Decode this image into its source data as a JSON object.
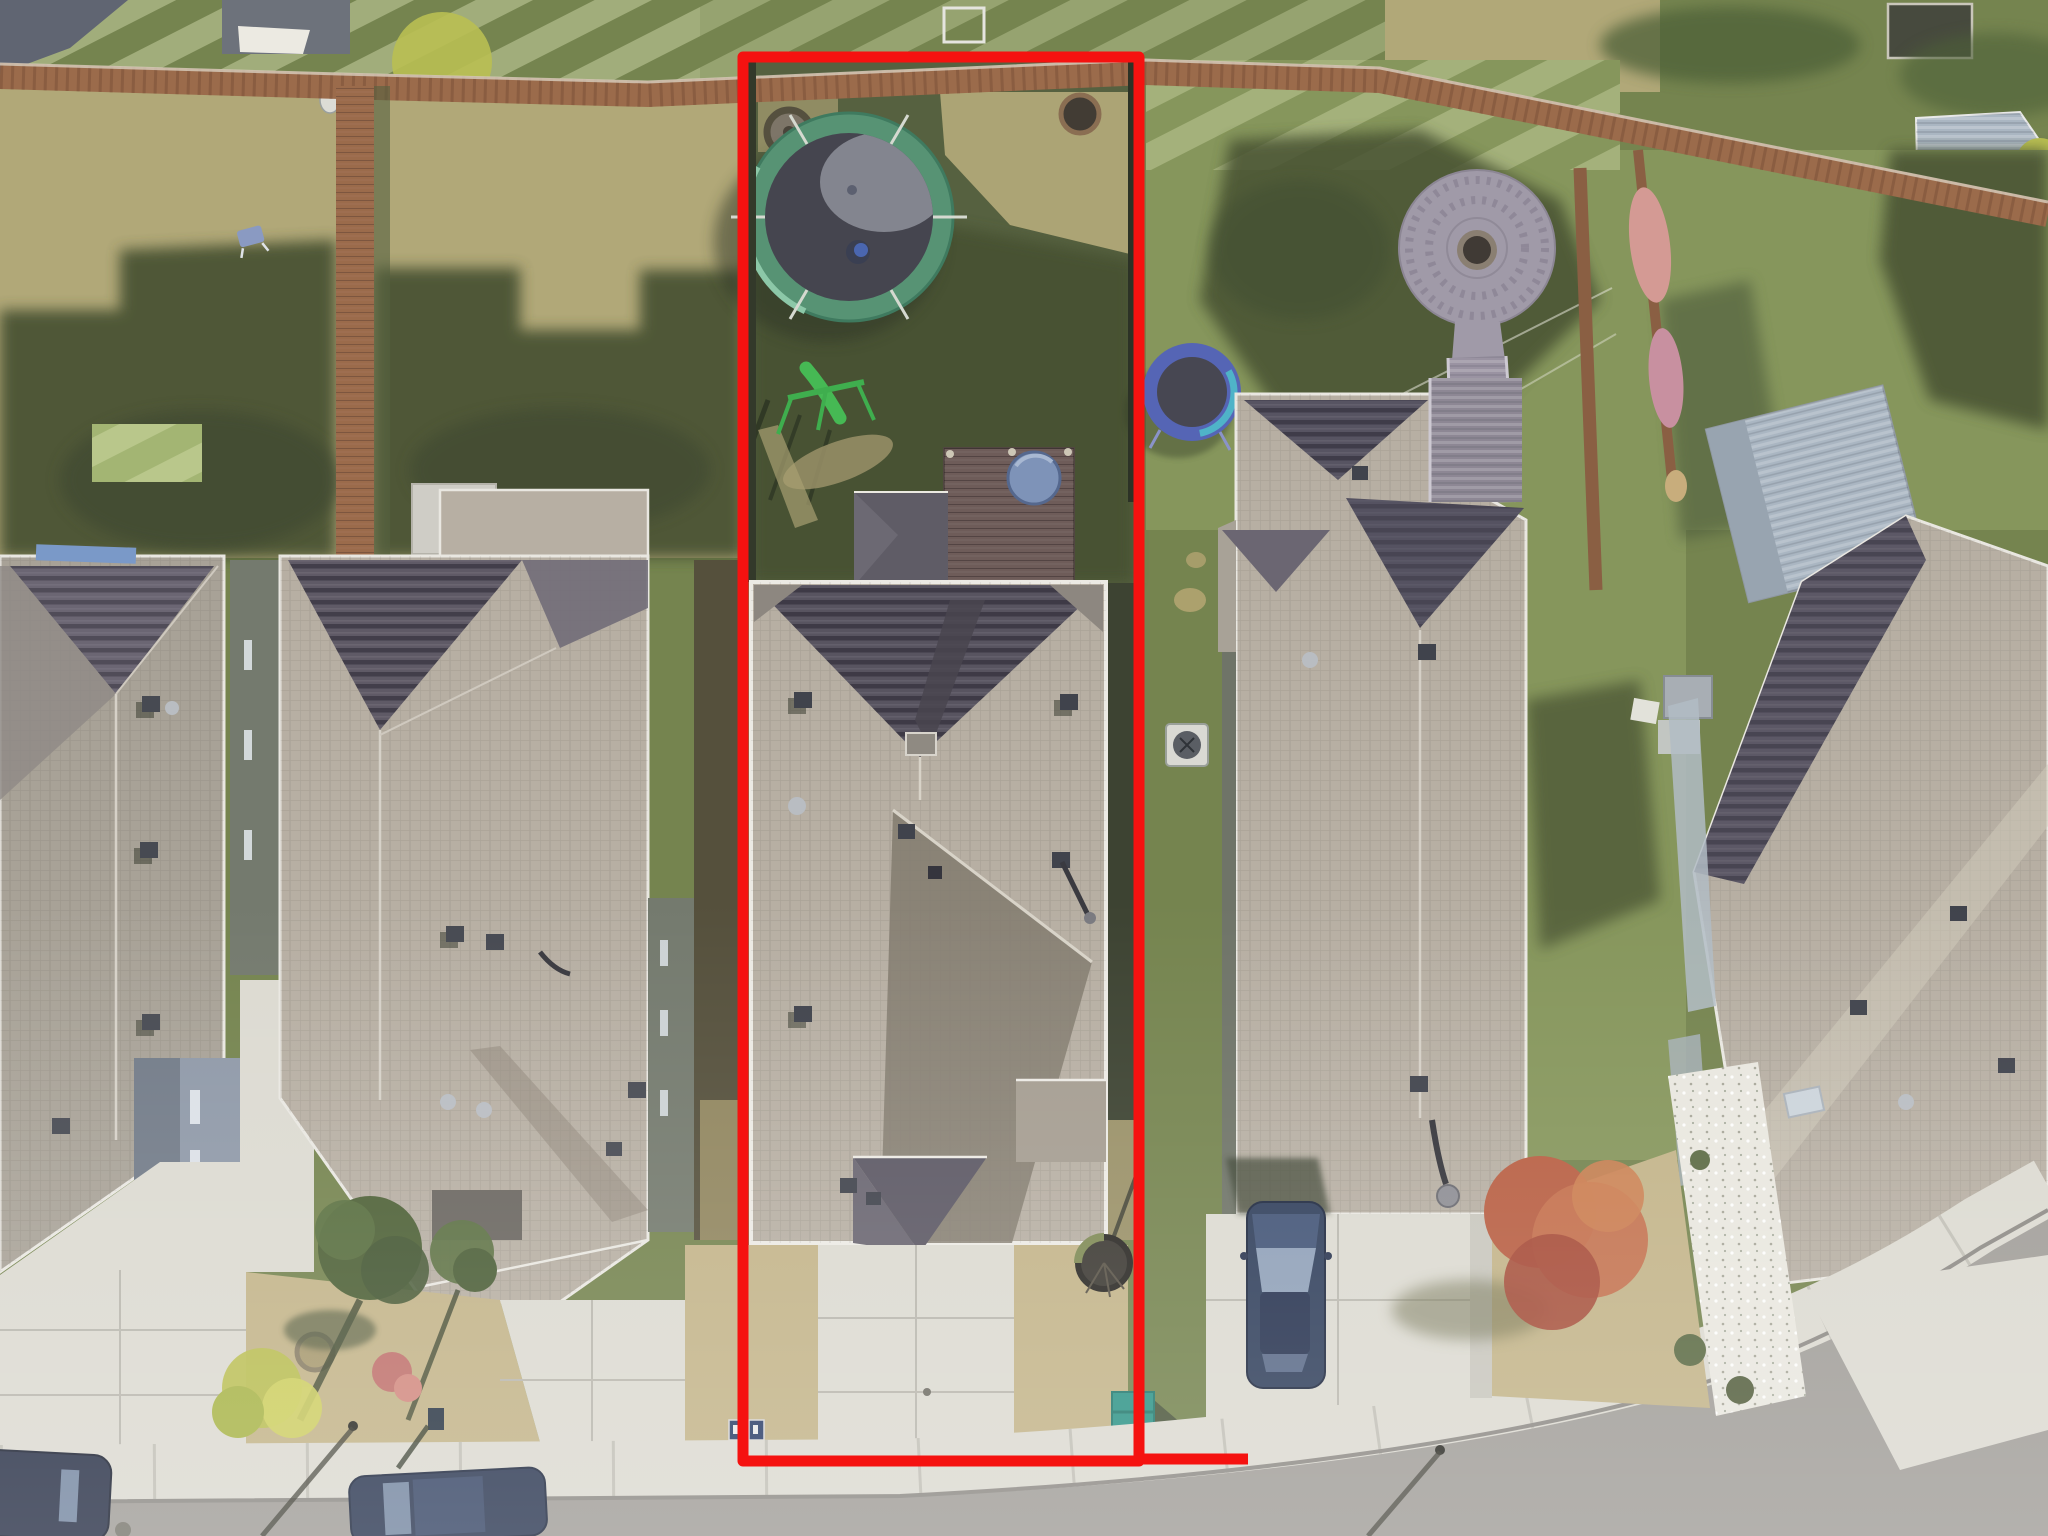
{
  "scene": {
    "type": "aerial-drone-photograph",
    "description": "Overhead aerial drone photo of a suburban street; a red rectangular outline marks the lot boundary of the center property with a gray hip-roof house, concrete driveway, backyard trampoline, green swing set, wood deck with hot-tub cover and a back fence line",
    "subject_property": {
      "label": "red-outlined lot",
      "features": [
        "green-edged trampoline",
        "green swing set with slide",
        "fire pit ring",
        "wood deck",
        "round hot tub cover",
        "gray shingle hip roof house",
        "concrete driveway",
        "dry tan front lawn",
        "young tree in planter ring",
        "teal trash bin"
      ]
    },
    "neighborhood_features": [
      "wood privacy fences",
      "striped mowed lawns",
      "circular paver patio with fire pit",
      "wood boardwalk",
      "blue ring trampoline",
      "air-conditioner unit",
      "blue car parked on driveway",
      "two dark cars parked on street",
      "curving sidewalk and asphalt street",
      "red autumn tree",
      "white gravel landscaping strip",
      "metal garden shed",
      "pink blankets draped on fence",
      "blue lawn chair"
    ]
  },
  "palette": {
    "boundary_red": "#f51210",
    "grass_base": "#75844f",
    "grass_sunlit": "#86965c",
    "grass_dry": "#b1a878",
    "grass_shadow": "#465133",
    "lawn_dead_tan": "#c3b489",
    "concrete": "#dcdad1",
    "concrete_shade": "#c9c7be",
    "asphalt": "#a19e99",
    "roof_light": "#b7afa3",
    "roof_mid": "#a8a297",
    "roof_dark": "#585460",
    "fascia_white": "#eceae2",
    "fence_wood": "#9b6b4b",
    "wall_blue_gray": "#8f99a8",
    "wall_gray_green": "#747a6e",
    "deck_wood": "#6e5c59",
    "hot_tub_blue": "#7e93b8",
    "trampoline_green": "#579374",
    "trampoline_mat": "#45454f",
    "trampoline_blue": "#5565b5",
    "trampoline_teal": "#4fb3c8",
    "swing_green": "#3fae4e",
    "paver_gray": "#a09aa8",
    "paver_center": "#403a35",
    "boardwalk_gray": "#9a93a2",
    "car_blue": "#31405c",
    "car_glass": "#8fa0b8",
    "tree_red": "#b85f43",
    "tree_green": "#4e6137",
    "bush_yellow": "#b9bf52",
    "blanket_pink": "#d49a94",
    "shed_metal": "#aab6c2",
    "bin_teal": "#2f9487",
    "ac_white": "#d9d9d3",
    "shadow_dark": "#3c4430"
  }
}
